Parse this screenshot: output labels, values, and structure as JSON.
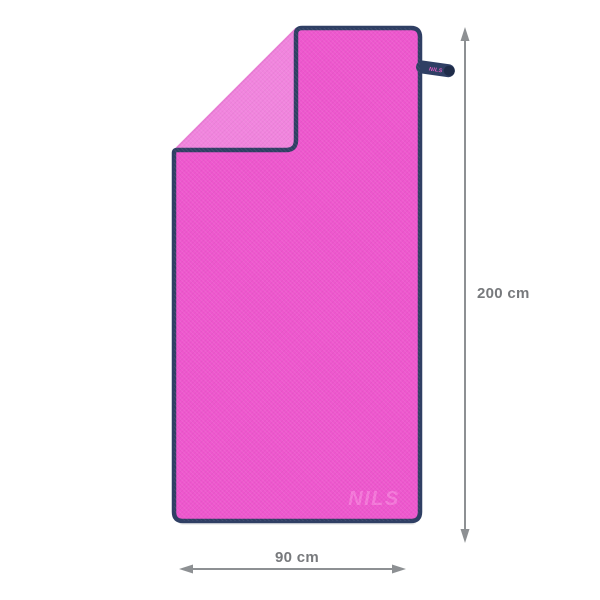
{
  "image": {
    "background_color": "#ffffff",
    "towel": {
      "front_color": "#ee57ce",
      "back_color": "#f184de",
      "trim_color": "#2f3f64",
      "crease_color": "#e05fc6",
      "shadow_color": "#d9d9d9",
      "watermark_text": "NILS",
      "watermark_color": "#f77edd",
      "tag": {
        "label": "NILS",
        "body_color": "#2f3f64",
        "text_color": "#e45fc4"
      }
    },
    "dimensions": {
      "height": {
        "label": "200 cm"
      },
      "width": {
        "label": "90 cm"
      },
      "arrow_color": "#8d9093",
      "label_color": "#77797c"
    }
  }
}
